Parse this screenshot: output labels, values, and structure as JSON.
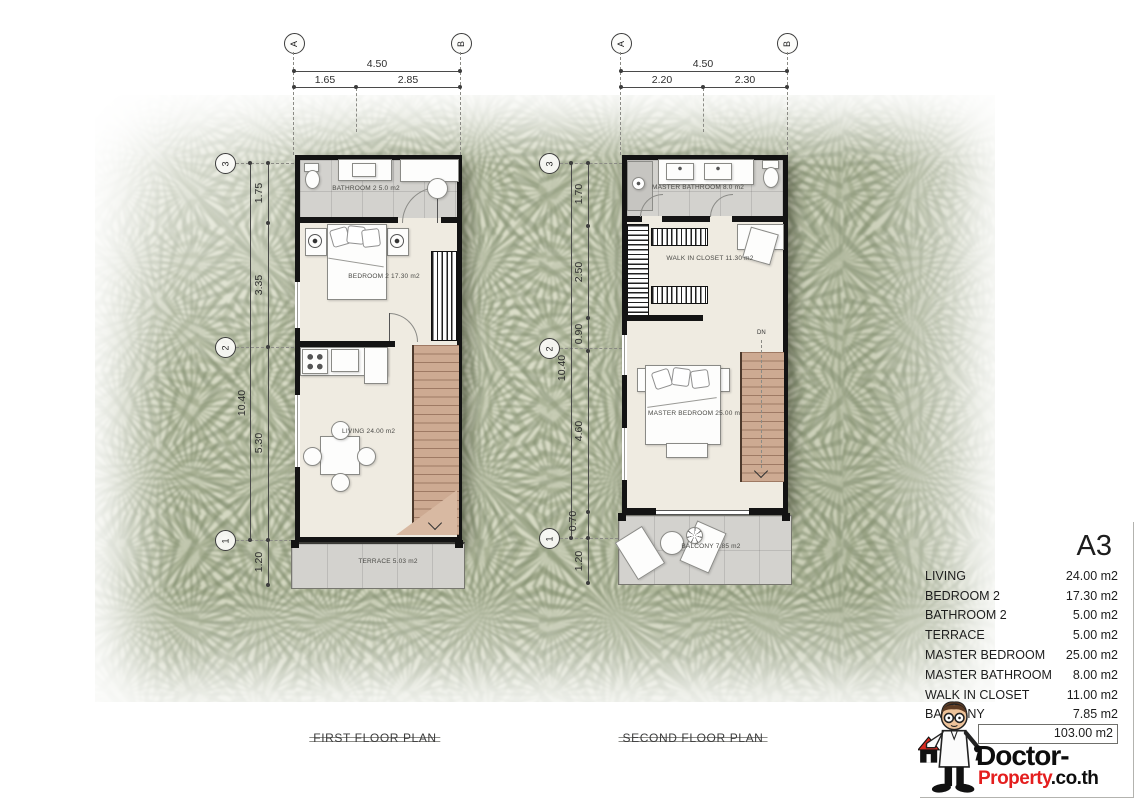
{
  "plans": {
    "first": {
      "caption": "FIRST FLOOR PLAN",
      "top_dim": {
        "bubbles": [
          "A",
          "B"
        ],
        "total": "4.50",
        "segments": [
          "1.65",
          "2.85"
        ]
      },
      "left_dim": {
        "bubbles": [
          "3",
          "2",
          "1"
        ],
        "total": "10.40",
        "segments": [
          "1.75",
          "3.35",
          "5.30",
          "1.20"
        ]
      },
      "rooms": {
        "bathroom2": "BATHROOM 2  5.0 m2",
        "bedroom2": "BEDROOM 2  17.30 m2",
        "living": "LIVING  24.00 m2",
        "terrace": "TERRACE  5.03 m2"
      }
    },
    "second": {
      "caption": "SECOND FLOOR PLAN",
      "top_dim": {
        "bubbles": [
          "A",
          "B"
        ],
        "total": "4.50",
        "segments": [
          "2.20",
          "2.30"
        ]
      },
      "left_dim": {
        "bubbles": [
          "3",
          "2",
          "1"
        ],
        "total": "10.40",
        "segments": [
          "1.70",
          "2.50",
          "0.90",
          "4.60",
          "0.70",
          "1.20"
        ]
      },
      "rooms": {
        "master_bathroom": "MASTER BATHROOM  8.0 m2",
        "walk_in_closet": "WALK IN CLOSET  11.30 m2",
        "master_bedroom": "MASTER BEDROOM  25.00 m2",
        "balcony": "BALCONY  7.85 m2"
      },
      "stair_down_label": "DN"
    }
  },
  "legend": {
    "unit_code": "A3",
    "rows": [
      {
        "label": "LIVING",
        "value": "24.00 m2"
      },
      {
        "label": "BEDROOM 2",
        "value": "17.30 m2"
      },
      {
        "label": "BATHROOM  2",
        "value": "5.00 m2"
      },
      {
        "label": "TERRACE",
        "value": "5.00 m2"
      },
      {
        "label": "MASTER BEDROOM",
        "value": "25.00 m2"
      },
      {
        "label": "MASTER BATHROOM",
        "value": "8.00 m2"
      },
      {
        "label": "WALK IN CLOSET",
        "value": "11.00 m2"
      },
      {
        "label": "BALCONY",
        "value": "7.85 m2"
      }
    ],
    "total_area": "103.00 m2"
  },
  "brand": {
    "line1": "Doctor-",
    "line2_red": "Property",
    "line2_suffix": ".co.th"
  },
  "colors": {
    "wall": "#141414",
    "floor": "#efebe1",
    "tile_gray": "#d3d2ce",
    "stair_wood": "#cdaa92",
    "brand_red": "#e41e1e",
    "photo_green": "#aeb694"
  }
}
